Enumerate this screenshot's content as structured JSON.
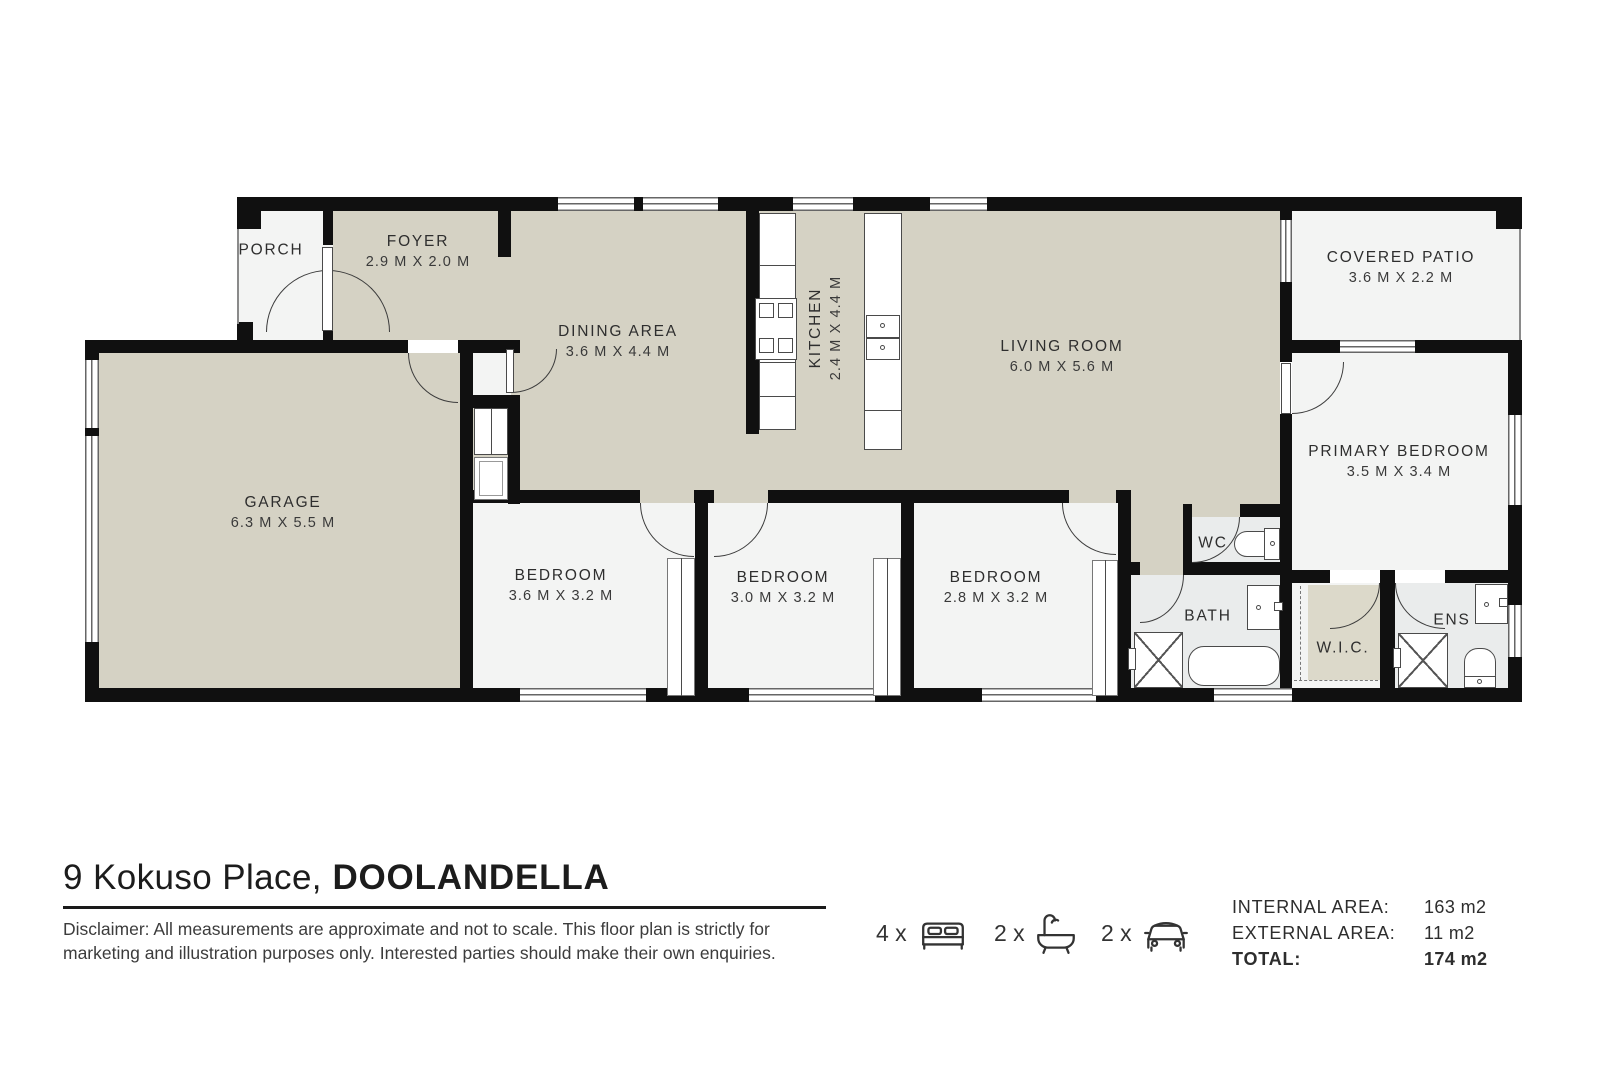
{
  "floorplan": {
    "rooms": [
      {
        "name": "PORCH",
        "dims": ""
      },
      {
        "name": "FOYER",
        "dims": "2.9 M X 2.0 M"
      },
      {
        "name": "DINING AREA",
        "dims": "3.6 M X 4.4 M"
      },
      {
        "name": "KITCHEN",
        "dims": "2.4 M X 4.4 M"
      },
      {
        "name": "LIVING ROOM",
        "dims": "6.0 M X 5.6 M"
      },
      {
        "name": "COVERED PATIO",
        "dims": "3.6 M X 2.2 M"
      },
      {
        "name": "PRIMARY BEDROOM",
        "dims": "3.5 M X 3.4 M"
      },
      {
        "name": "GARAGE",
        "dims": "6.3 M X 5.5 M"
      },
      {
        "name": "BEDROOM",
        "dims": "3.6 M X 3.2 M"
      },
      {
        "name": "BEDROOM",
        "dims": "3.0 M X 3.2 M"
      },
      {
        "name": "BEDROOM",
        "dims": "2.8 M X 3.2 M"
      },
      {
        "name": "WC",
        "dims": ""
      },
      {
        "name": "BATH",
        "dims": ""
      },
      {
        "name": "W.I.C.",
        "dims": ""
      },
      {
        "name": "ENS",
        "dims": ""
      }
    ],
    "colors": {
      "floor_beige": "#d5d2c4",
      "floor_white": "#f3f4f3",
      "wall": "#101010"
    }
  },
  "footer": {
    "address_regular": "9 Kokuso Place,",
    "address_bold": " DOOLANDELLA",
    "disclaimer": "Disclaimer: All measurements are approximate and not to scale. This floor plan is strictly for marketing and illustration purposes only. Interested parties should make their own enquiries.",
    "counts": [
      {
        "qty": "4 x",
        "icon": "bed-icon"
      },
      {
        "qty": "2 x",
        "icon": "bathtub-icon"
      },
      {
        "qty": "2 x",
        "icon": "car-icon"
      }
    ],
    "stats": [
      {
        "label": "INTERNAL AREA:",
        "value": "163 m2"
      },
      {
        "label": "EXTERNAL AREA:",
        "value": "11 m2"
      },
      {
        "label": "TOTAL:",
        "value": "174 m2"
      }
    ]
  }
}
